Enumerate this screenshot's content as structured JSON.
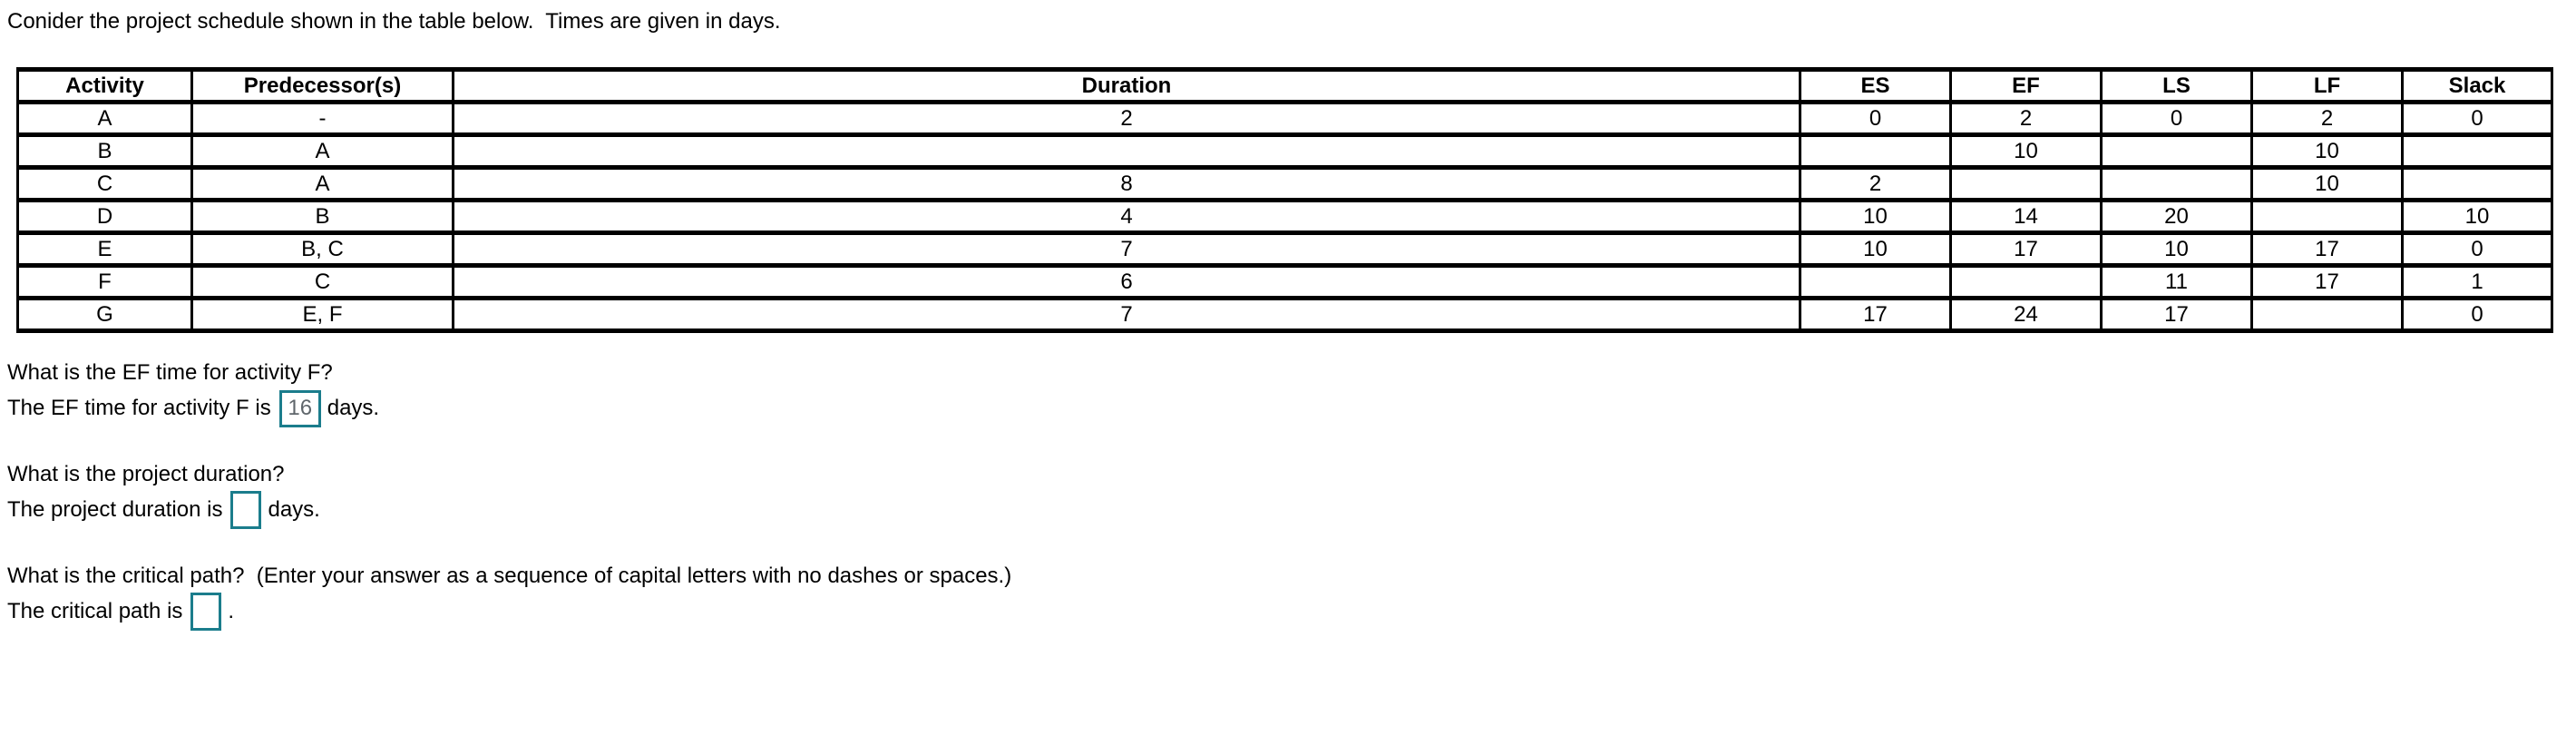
{
  "intro": "Conider the project schedule shown in the table below.  Times are given in days.",
  "colors": {
    "answer_box_border": "#1b7d8c",
    "answer_text_gray": "#5f666b",
    "table_border": "#000000",
    "background": "#ffffff"
  },
  "table": {
    "headers": [
      "Activity",
      "Predecessor(s)",
      "Duration",
      "ES",
      "EF",
      "LS",
      "LF",
      "Slack"
    ],
    "rows": [
      {
        "activity": "A",
        "predecessors": "-",
        "duration": "2",
        "es": "0",
        "ef": "2",
        "ls": "0",
        "lf": "2",
        "slack": "0"
      },
      {
        "activity": "B",
        "predecessors": "A",
        "duration": "",
        "es": "",
        "ef": "10",
        "ls": "",
        "lf": "10",
        "slack": ""
      },
      {
        "activity": "C",
        "predecessors": "A",
        "duration": "8",
        "es": "2",
        "ef": "",
        "ls": "",
        "lf": "10",
        "slack": ""
      },
      {
        "activity": "D",
        "predecessors": "B",
        "duration": "4",
        "es": "10",
        "ef": "14",
        "ls": "20",
        "lf": "",
        "slack": "10"
      },
      {
        "activity": "E",
        "predecessors": "B, C",
        "duration": "7",
        "es": "10",
        "ef": "17",
        "ls": "10",
        "lf": "17",
        "slack": "0"
      },
      {
        "activity": "F",
        "predecessors": "C",
        "duration": "6",
        "es": "",
        "ef": "",
        "ls": "11",
        "lf": "17",
        "slack": "1"
      },
      {
        "activity": "G",
        "predecessors": "E, F",
        "duration": "7",
        "es": "17",
        "ef": "24",
        "ls": "17",
        "lf": "",
        "slack": "0"
      }
    ]
  },
  "questions": {
    "q1": {
      "prompt": "What is the EF time for activity F?",
      "answer_prefix": "The EF time for activity F is",
      "answer_value": "16",
      "answer_suffix": "days."
    },
    "q2": {
      "prompt": "What is the project duration?",
      "answer_prefix": "The project duration is",
      "answer_value": "",
      "answer_suffix": "days."
    },
    "q3": {
      "prompt": "What is the critical path?  (Enter your answer as a sequence of capital letters with no dashes or spaces.)",
      "answer_prefix": "The critical path is",
      "answer_value": "",
      "answer_suffix": "."
    }
  }
}
